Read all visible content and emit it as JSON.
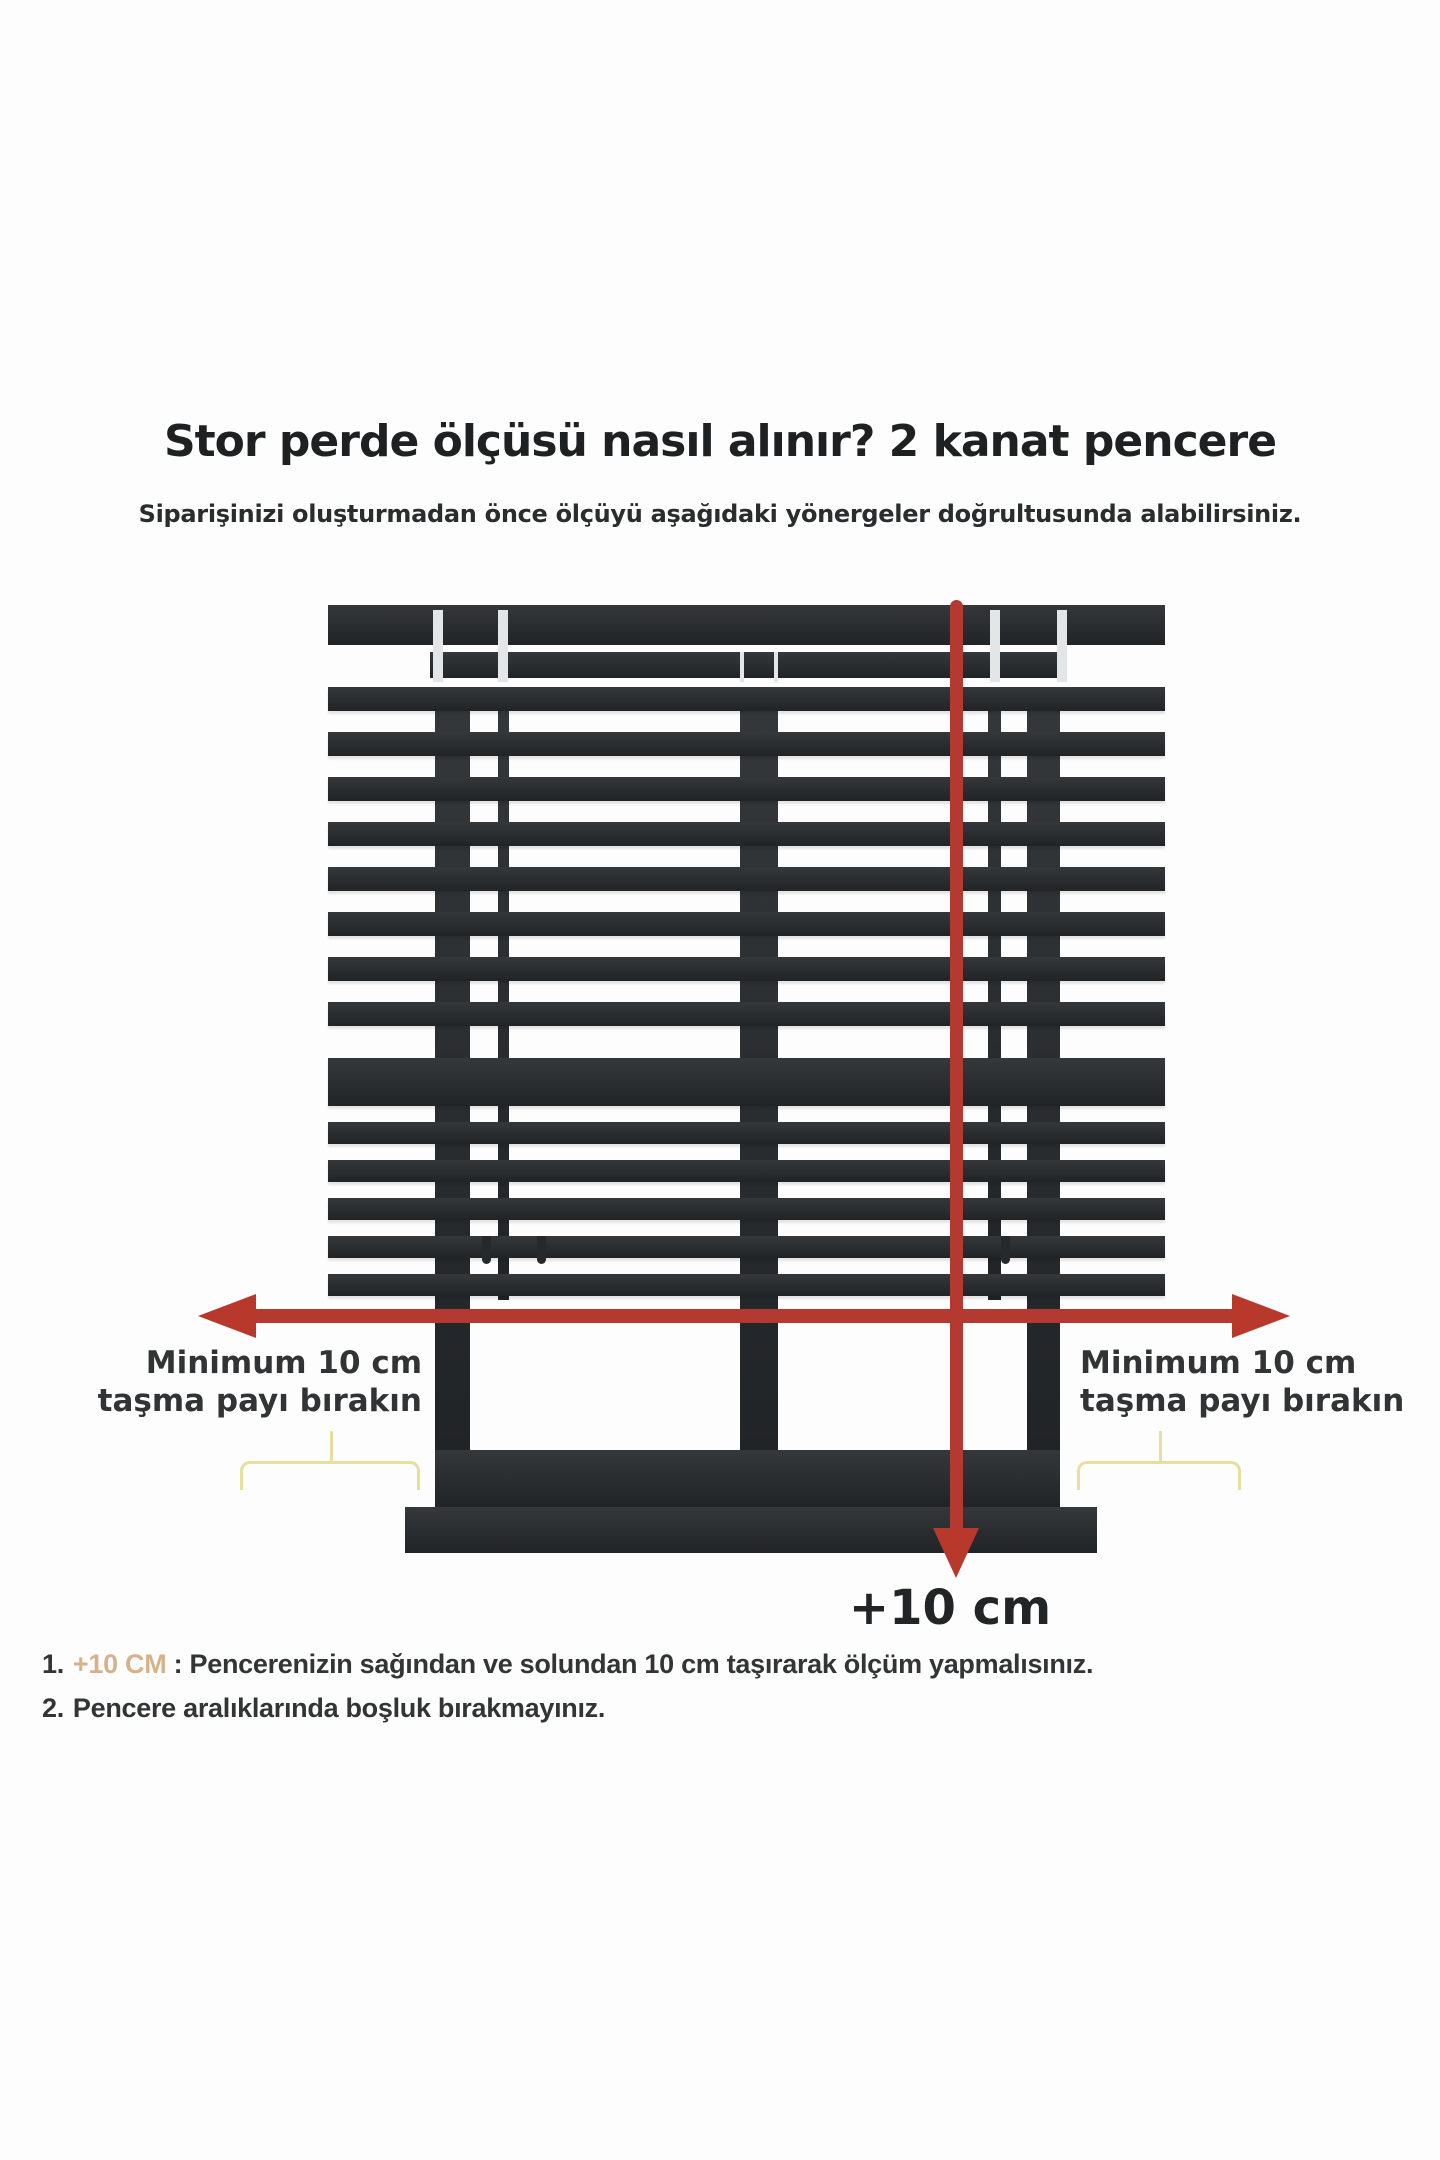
{
  "header": {
    "title": "Stor perde ölçüsü nasıl alınır? 2 kanat pencere",
    "subtitle": "Siparişinizi oluşturmadan önce ölçüyü aşağıdaki yönergeler doğrultusunda alabilirsiniz."
  },
  "diagram": {
    "left_label": {
      "line1": "Minimum 10 cm",
      "line2": "taşma payı bırakın"
    },
    "right_label": {
      "line1": "Minimum 10 cm",
      "line2": "taşma payı bırakın"
    },
    "bottom_measure_label": "+10 cm",
    "colors": {
      "window_dark": "#26292b",
      "arrow_red": "#b43a31",
      "brace_yellow": "#e7df9e",
      "highlight_tan": "#d6b28a"
    }
  },
  "instructions": {
    "item1": {
      "number": "1.",
      "highlight": "+10 CM",
      "rest": " : Pencerenizin sağından ve solundan 10 cm taşırarak ölçüm yapmalısınız."
    },
    "item2": {
      "number": "2.",
      "text": "Pencere aralıklarında boşluk bırakmayınız."
    }
  }
}
